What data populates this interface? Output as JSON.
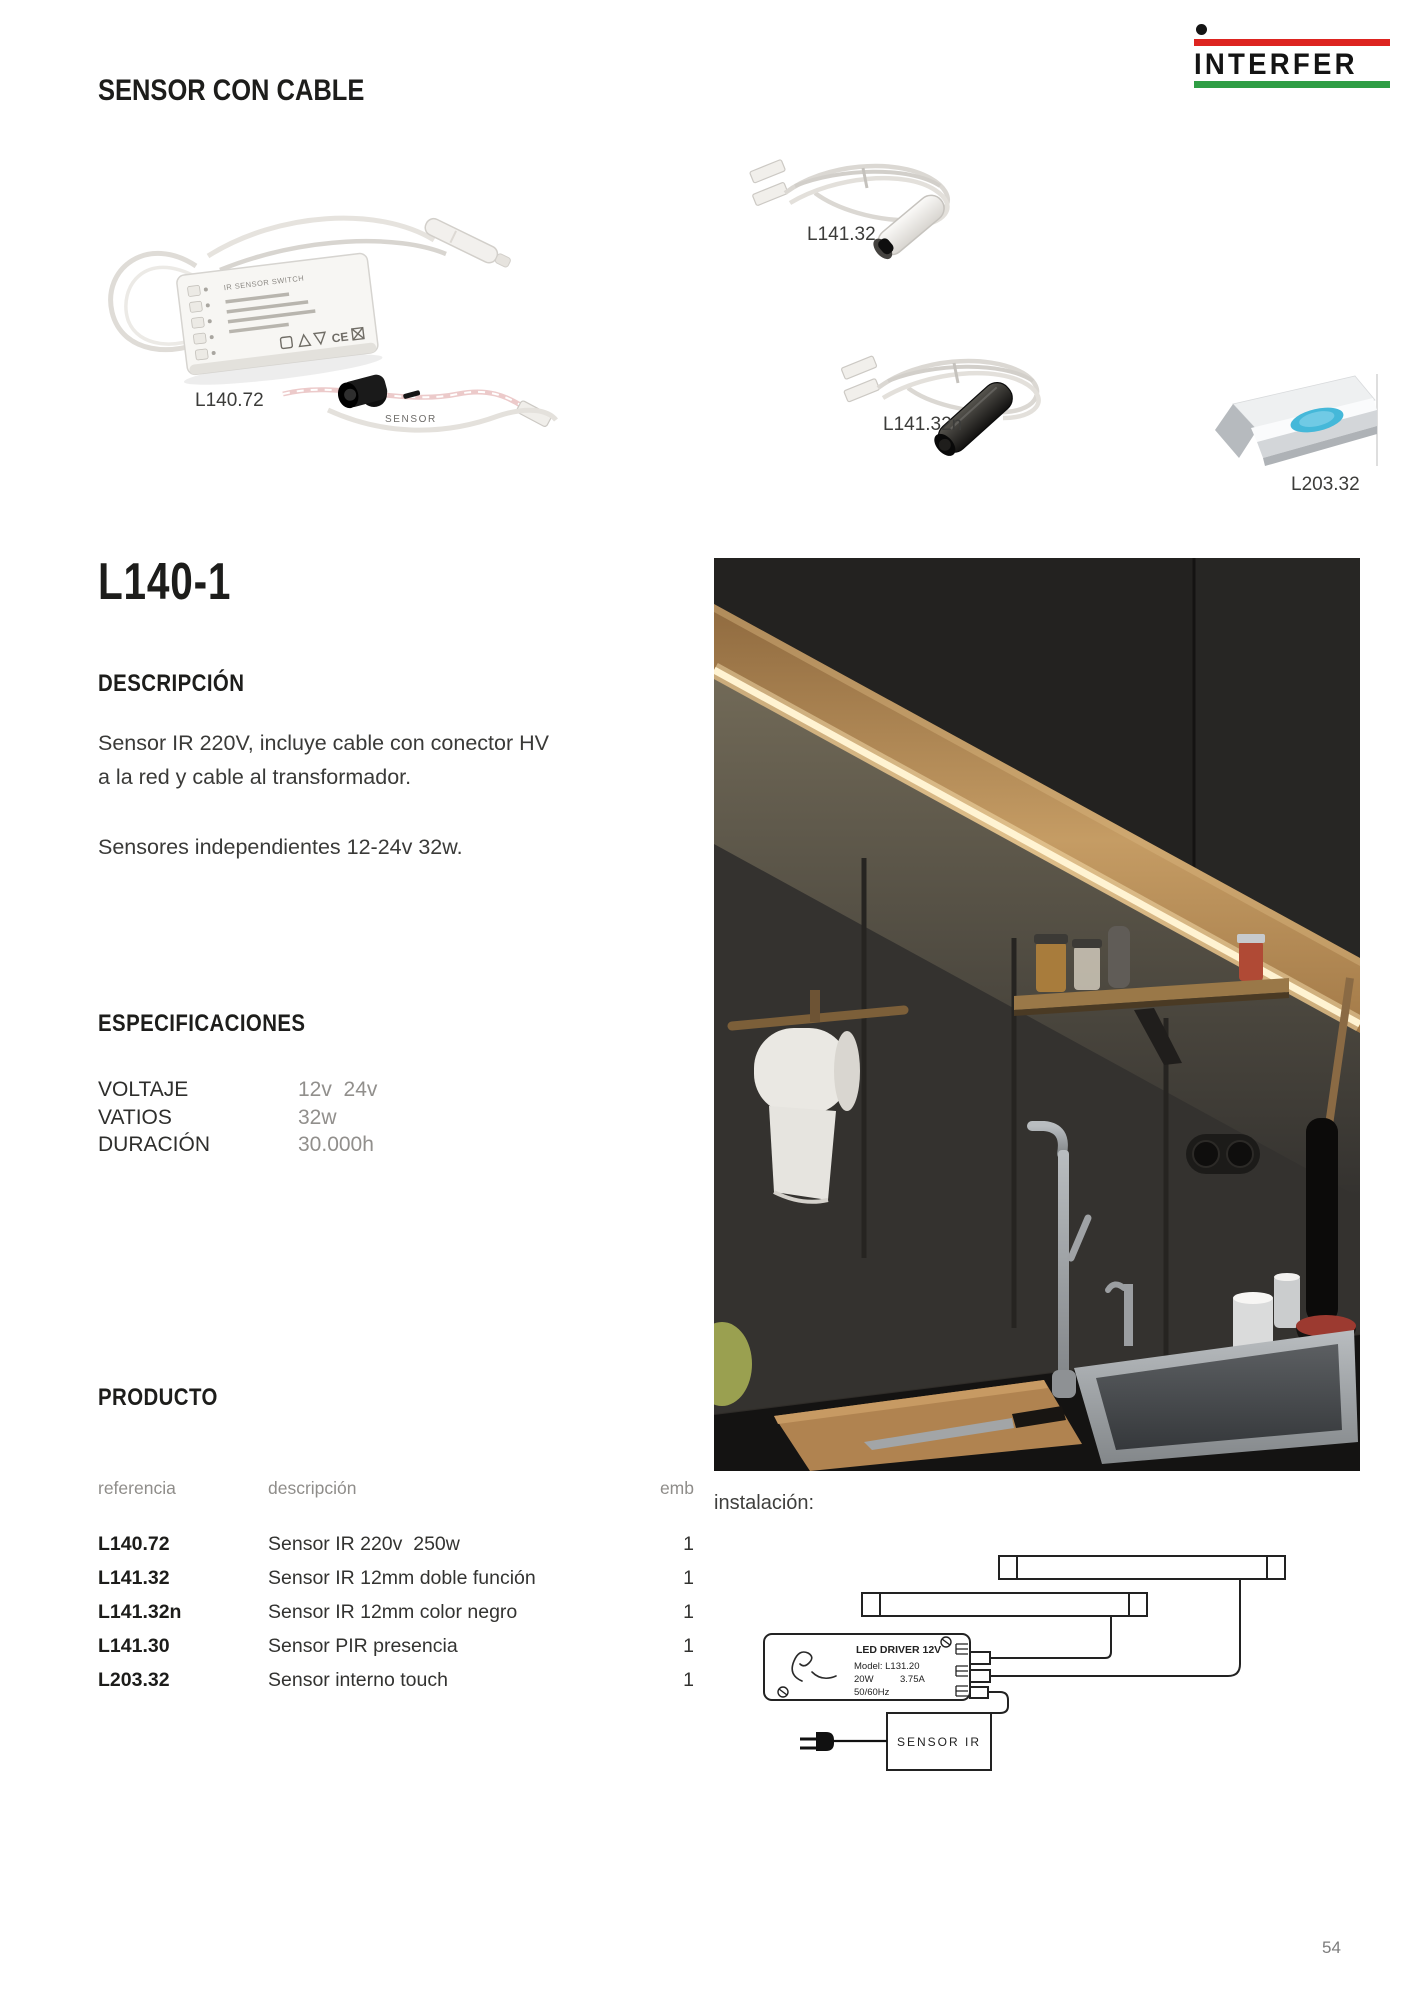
{
  "brand": {
    "name": "INTERFER",
    "red": "#dd2420",
    "green": "#2f9e45",
    "dot_black": "#141414"
  },
  "header": {
    "title": "SENSOR CON CABLE"
  },
  "gallery": {
    "l140_72": {
      "label": "L140.72",
      "box_title": "IR SENSOR SWITCH",
      "cert_label": "CE",
      "sensor_caption": "SENSOR"
    },
    "l141_32": {
      "label": "L141.32"
    },
    "l141_32n": {
      "label": "L141.32n"
    },
    "l203_32": {
      "label": "L203.32"
    }
  },
  "section": {
    "code": "L140-1",
    "descripcion_heading": "DESCRIPCIÓN",
    "descripcion": [
      "Sensor IR 220V, incluye cable con conector HV",
      "a la red y cable al transformador."
    ],
    "descripcion2": "Sensores independientes 12-24v 32w.",
    "especificaciones_heading": "ESPECIFICACIONES",
    "especificaciones": [
      {
        "label": "VOLTAJE",
        "value": "12v  24v"
      },
      {
        "label": "VATIOS",
        "value": "32w"
      },
      {
        "label": "DURACIÓN",
        "value": "30.000h"
      }
    ],
    "producto_heading": "PRODUCTO",
    "producto_columns": {
      "referencia": "referencia",
      "descripcion": "descripción",
      "emb": "emb"
    },
    "producto_rows": [
      {
        "ref": "L140.72",
        "desc": "Sensor IR 220v  250w",
        "emb": "1"
      },
      {
        "ref": "L141.32",
        "desc": "Sensor IR 12mm doble función",
        "emb": "1"
      },
      {
        "ref": "L141.32n",
        "desc": "Sensor IR 12mm color negro",
        "emb": "1"
      },
      {
        "ref": "L141.30",
        "desc": "Sensor PIR presencia",
        "emb": "1"
      },
      {
        "ref": "L203.32",
        "desc": "Sensor interno touch",
        "emb": "1"
      }
    ]
  },
  "installation": {
    "label": "instalación:",
    "driver_line1": "LED DRIVER 12V",
    "driver_line2": "Model: L131.20",
    "driver_power": "20W",
    "driver_current": "3.75A",
    "driver_line4": "50/60Hz",
    "sensor_box_label": "SENSOR IR"
  },
  "footer": {
    "page_number": "54"
  }
}
